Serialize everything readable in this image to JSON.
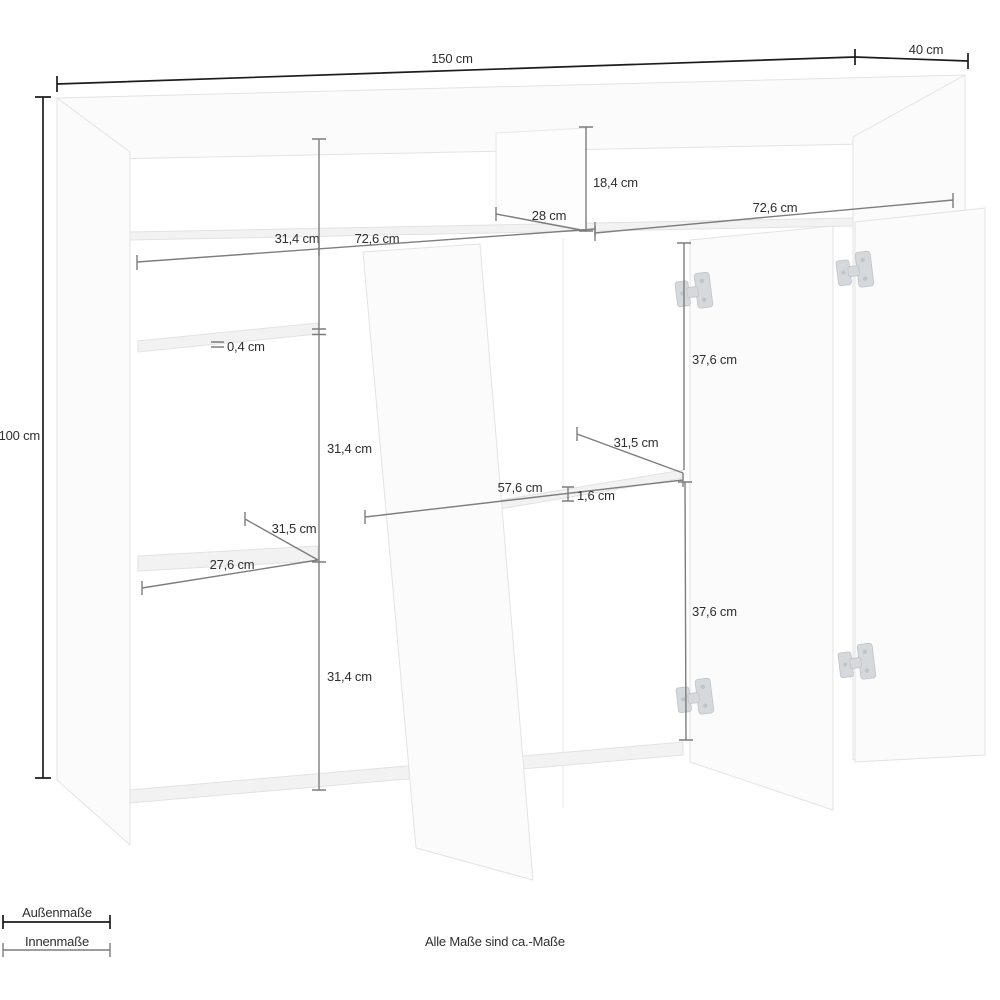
{
  "note": "Alle Maße sind ca.-Maße",
  "legend": {
    "outer_label": "Außenmaße",
    "inner_label": "Innenmaße"
  },
  "colors": {
    "outer_dimension_line": "#1c1c1c",
    "inner_dimension_line": "#7d7d7d",
    "label_text": "#2e2e2e",
    "furniture_edge": "#e3e3e3",
    "hinge_metal": "#d6d9dc",
    "background": "#ffffff"
  },
  "dimensions": {
    "total_width": "150 cm",
    "total_depth": "40 cm",
    "total_height": "100 cm",
    "top_niche_height": "18,4 cm",
    "top_divider_width": "28 cm",
    "top_niche_right_width": "72,6 cm",
    "left_bay_width": "31,4 cm",
    "middle_section_width": "72,6 cm",
    "glass_shelf_thickness": "0,4 cm",
    "left_upper_compartment_height": "31,4 cm",
    "left_shelf_depth": "31,5 cm",
    "left_shelf_width": "27,6 cm",
    "left_lower_compartment_height": "31,4 cm",
    "right_upper_door_height": "37,6 cm",
    "middle_shelf_depth": "31,5 cm",
    "middle_shelf_width": "57,6 cm",
    "shelf_thickness": "1,6 cm",
    "right_lower_door_height": "37,6 cm"
  }
}
